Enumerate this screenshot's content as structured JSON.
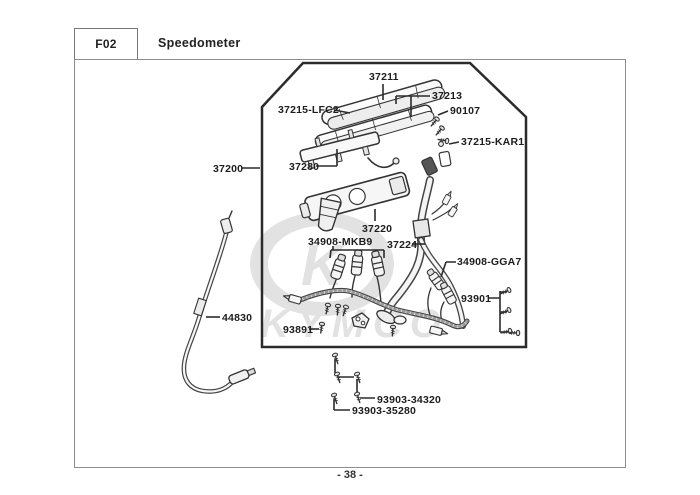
{
  "page": {
    "code": "F02",
    "title": "Speedometer",
    "page_number": "- 38 -"
  },
  "watermark": {
    "brand": "KYMCO",
    "emblem_letter": "K",
    "color": "#cccccc"
  },
  "diagram": {
    "type": "exploded-parts-diagram",
    "border_color": "#2b2b2b",
    "line_color": "#333333",
    "labels": [
      {
        "label": "37211"
      },
      {
        "label": "37213"
      },
      {
        "label": "37215-LFC2"
      },
      {
        "label": "90107"
      },
      {
        "label": "37215-KAR1"
      },
      {
        "label": "37200"
      },
      {
        "label": "37280"
      },
      {
        "label": "37220"
      },
      {
        "label": "34908-MKB9"
      },
      {
        "label": "37224"
      },
      {
        "label": "34908-GGA7"
      },
      {
        "label": "93901"
      },
      {
        "label": "93891"
      },
      {
        "label": "44830"
      },
      {
        "label": "93903-34320"
      },
      {
        "label": "93903-35280"
      }
    ]
  }
}
